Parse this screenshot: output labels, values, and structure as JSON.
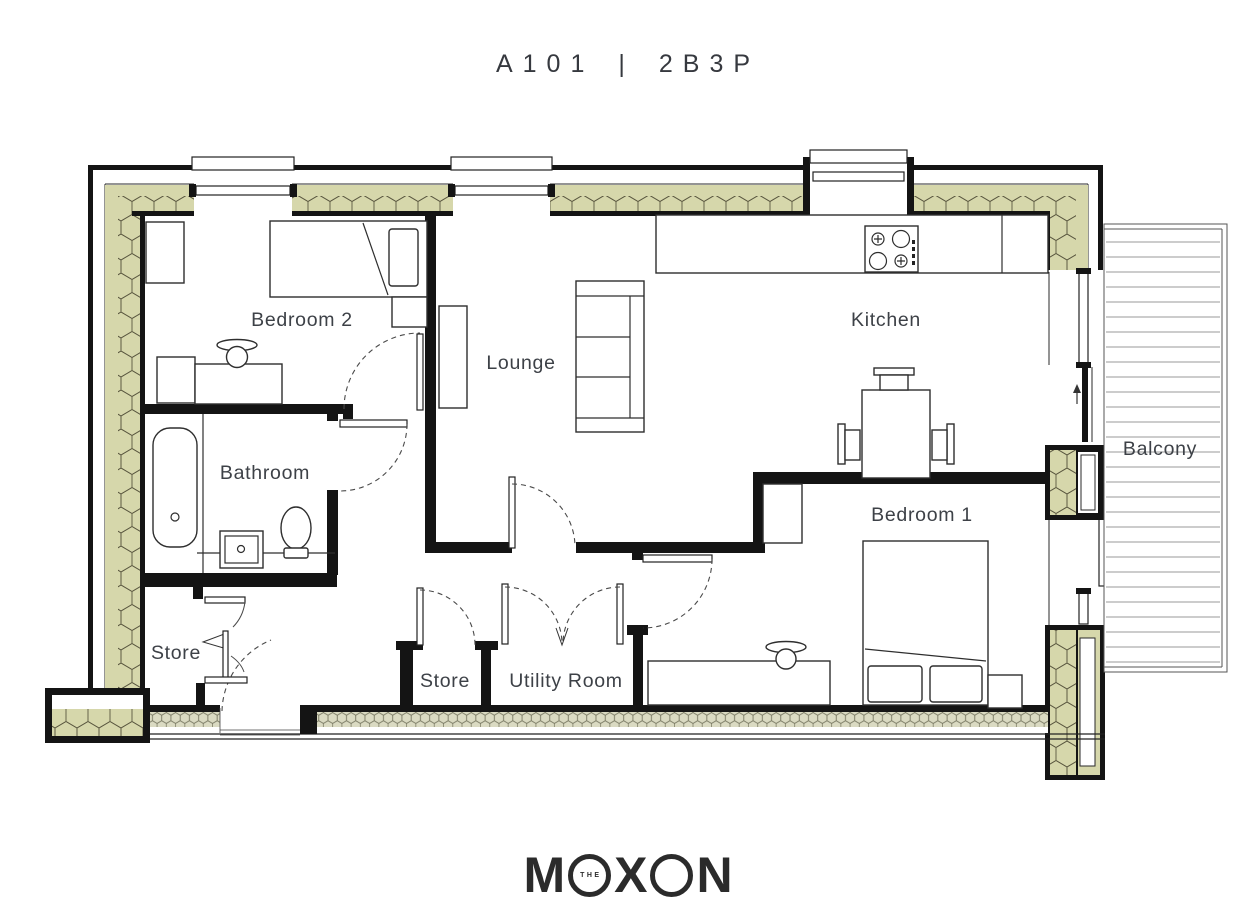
{
  "header": {
    "unit_number": "A101",
    "separator": "|",
    "unit_type": "2B3P"
  },
  "rooms": {
    "bedroom2": {
      "label": "Bedroom 2"
    },
    "lounge": {
      "label": "Lounge"
    },
    "kitchen": {
      "label": "Kitchen"
    },
    "bathroom": {
      "label": "Bathroom"
    },
    "balcony": {
      "label": "Balcony"
    },
    "bedroom1": {
      "label": "Bedroom 1"
    },
    "store_hall": {
      "label": "Store"
    },
    "store_mid": {
      "label": "Store"
    },
    "utility": {
      "label": "Utility Room"
    }
  },
  "logo": {
    "brand": "MOXON",
    "prefix": "THE",
    "letter_m": "M",
    "letter_x": "X",
    "letter_n": "N"
  },
  "fixtures": [
    "single-bed",
    "double-bed",
    "wardrobe",
    "bedside-table",
    "desk",
    "dresser",
    "vase",
    "sofa",
    "tv-unit",
    "kitchen-counter",
    "stove-hob",
    "dining-table",
    "dining-chair",
    "bathtub",
    "washbasin",
    "toilet",
    "balcony-decking",
    "sliding-door",
    "entry-door"
  ],
  "colors": {
    "insulation": "#d6d7ab",
    "insulation_dense": "#dadac2",
    "wall": "#141414",
    "label_text": "#3d4147",
    "deck_line": "#9a9a9a",
    "logo_text": "#2b2b2b"
  }
}
